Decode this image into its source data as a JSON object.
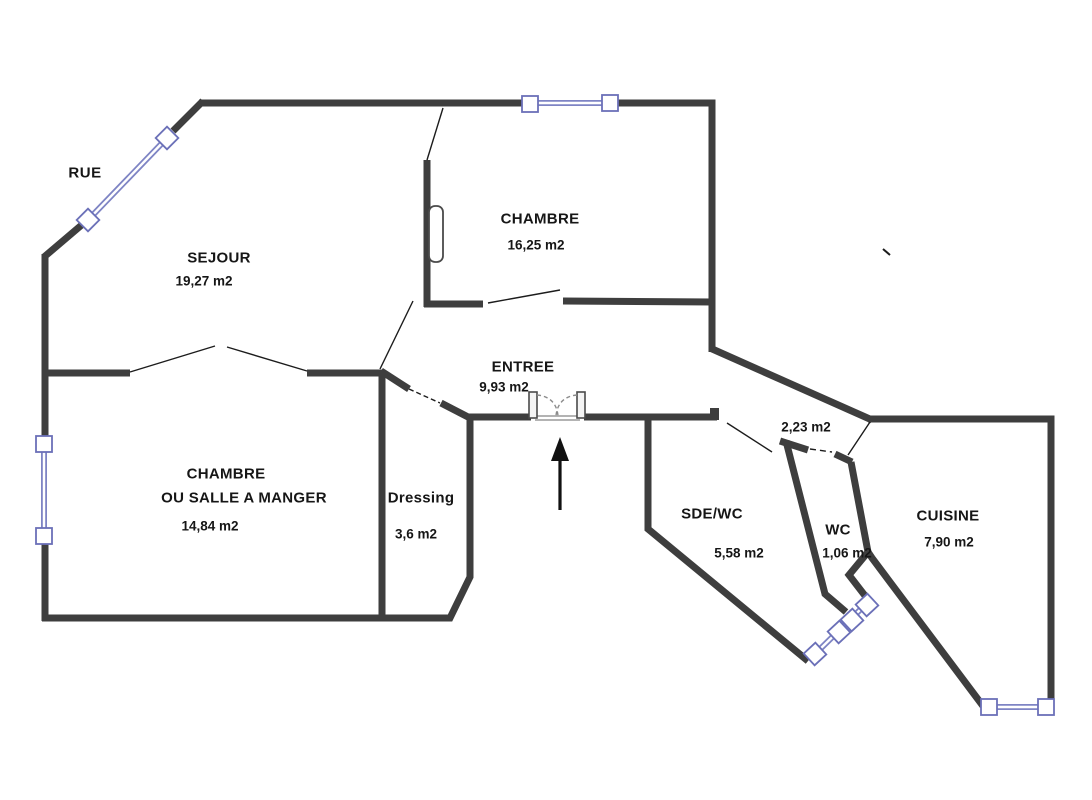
{
  "plan": {
    "street_label": "RUE",
    "rooms": [
      {
        "id": "sejour",
        "name": "SEJOUR",
        "area": "19,27 m2"
      },
      {
        "id": "chambre",
        "name": "CHAMBRE",
        "area": "16,25 m2"
      },
      {
        "id": "entree",
        "name": "ENTREE",
        "area": "9,93 m2"
      },
      {
        "id": "chambre_ou_salle_a_manger",
        "name": "CHAMBRE",
        "name_line2": "OU SALLE A MANGER",
        "area": "14,84 m2"
      },
      {
        "id": "dressing",
        "name": "Dressing",
        "area": "3,6 m2"
      },
      {
        "id": "sde_wc",
        "name": "SDE/WC",
        "area": "5,58 m2"
      },
      {
        "id": "wc",
        "name": "WC",
        "area": "1,06 m2"
      },
      {
        "id": "couloir",
        "name": "",
        "area": "2,23 m2"
      },
      {
        "id": "cuisine",
        "name": "CUISINE",
        "area": "7,90 m2"
      }
    ],
    "symbols": {
      "window": "window-symbol",
      "entrance_door": "double-swing-door-symbol",
      "entrance_arrow": "up-arrow"
    },
    "colors": {
      "wall": "#3e3e3e",
      "window_blue": "#7e84c4",
      "label_text": "#161616",
      "background": "#ffffff"
    }
  }
}
